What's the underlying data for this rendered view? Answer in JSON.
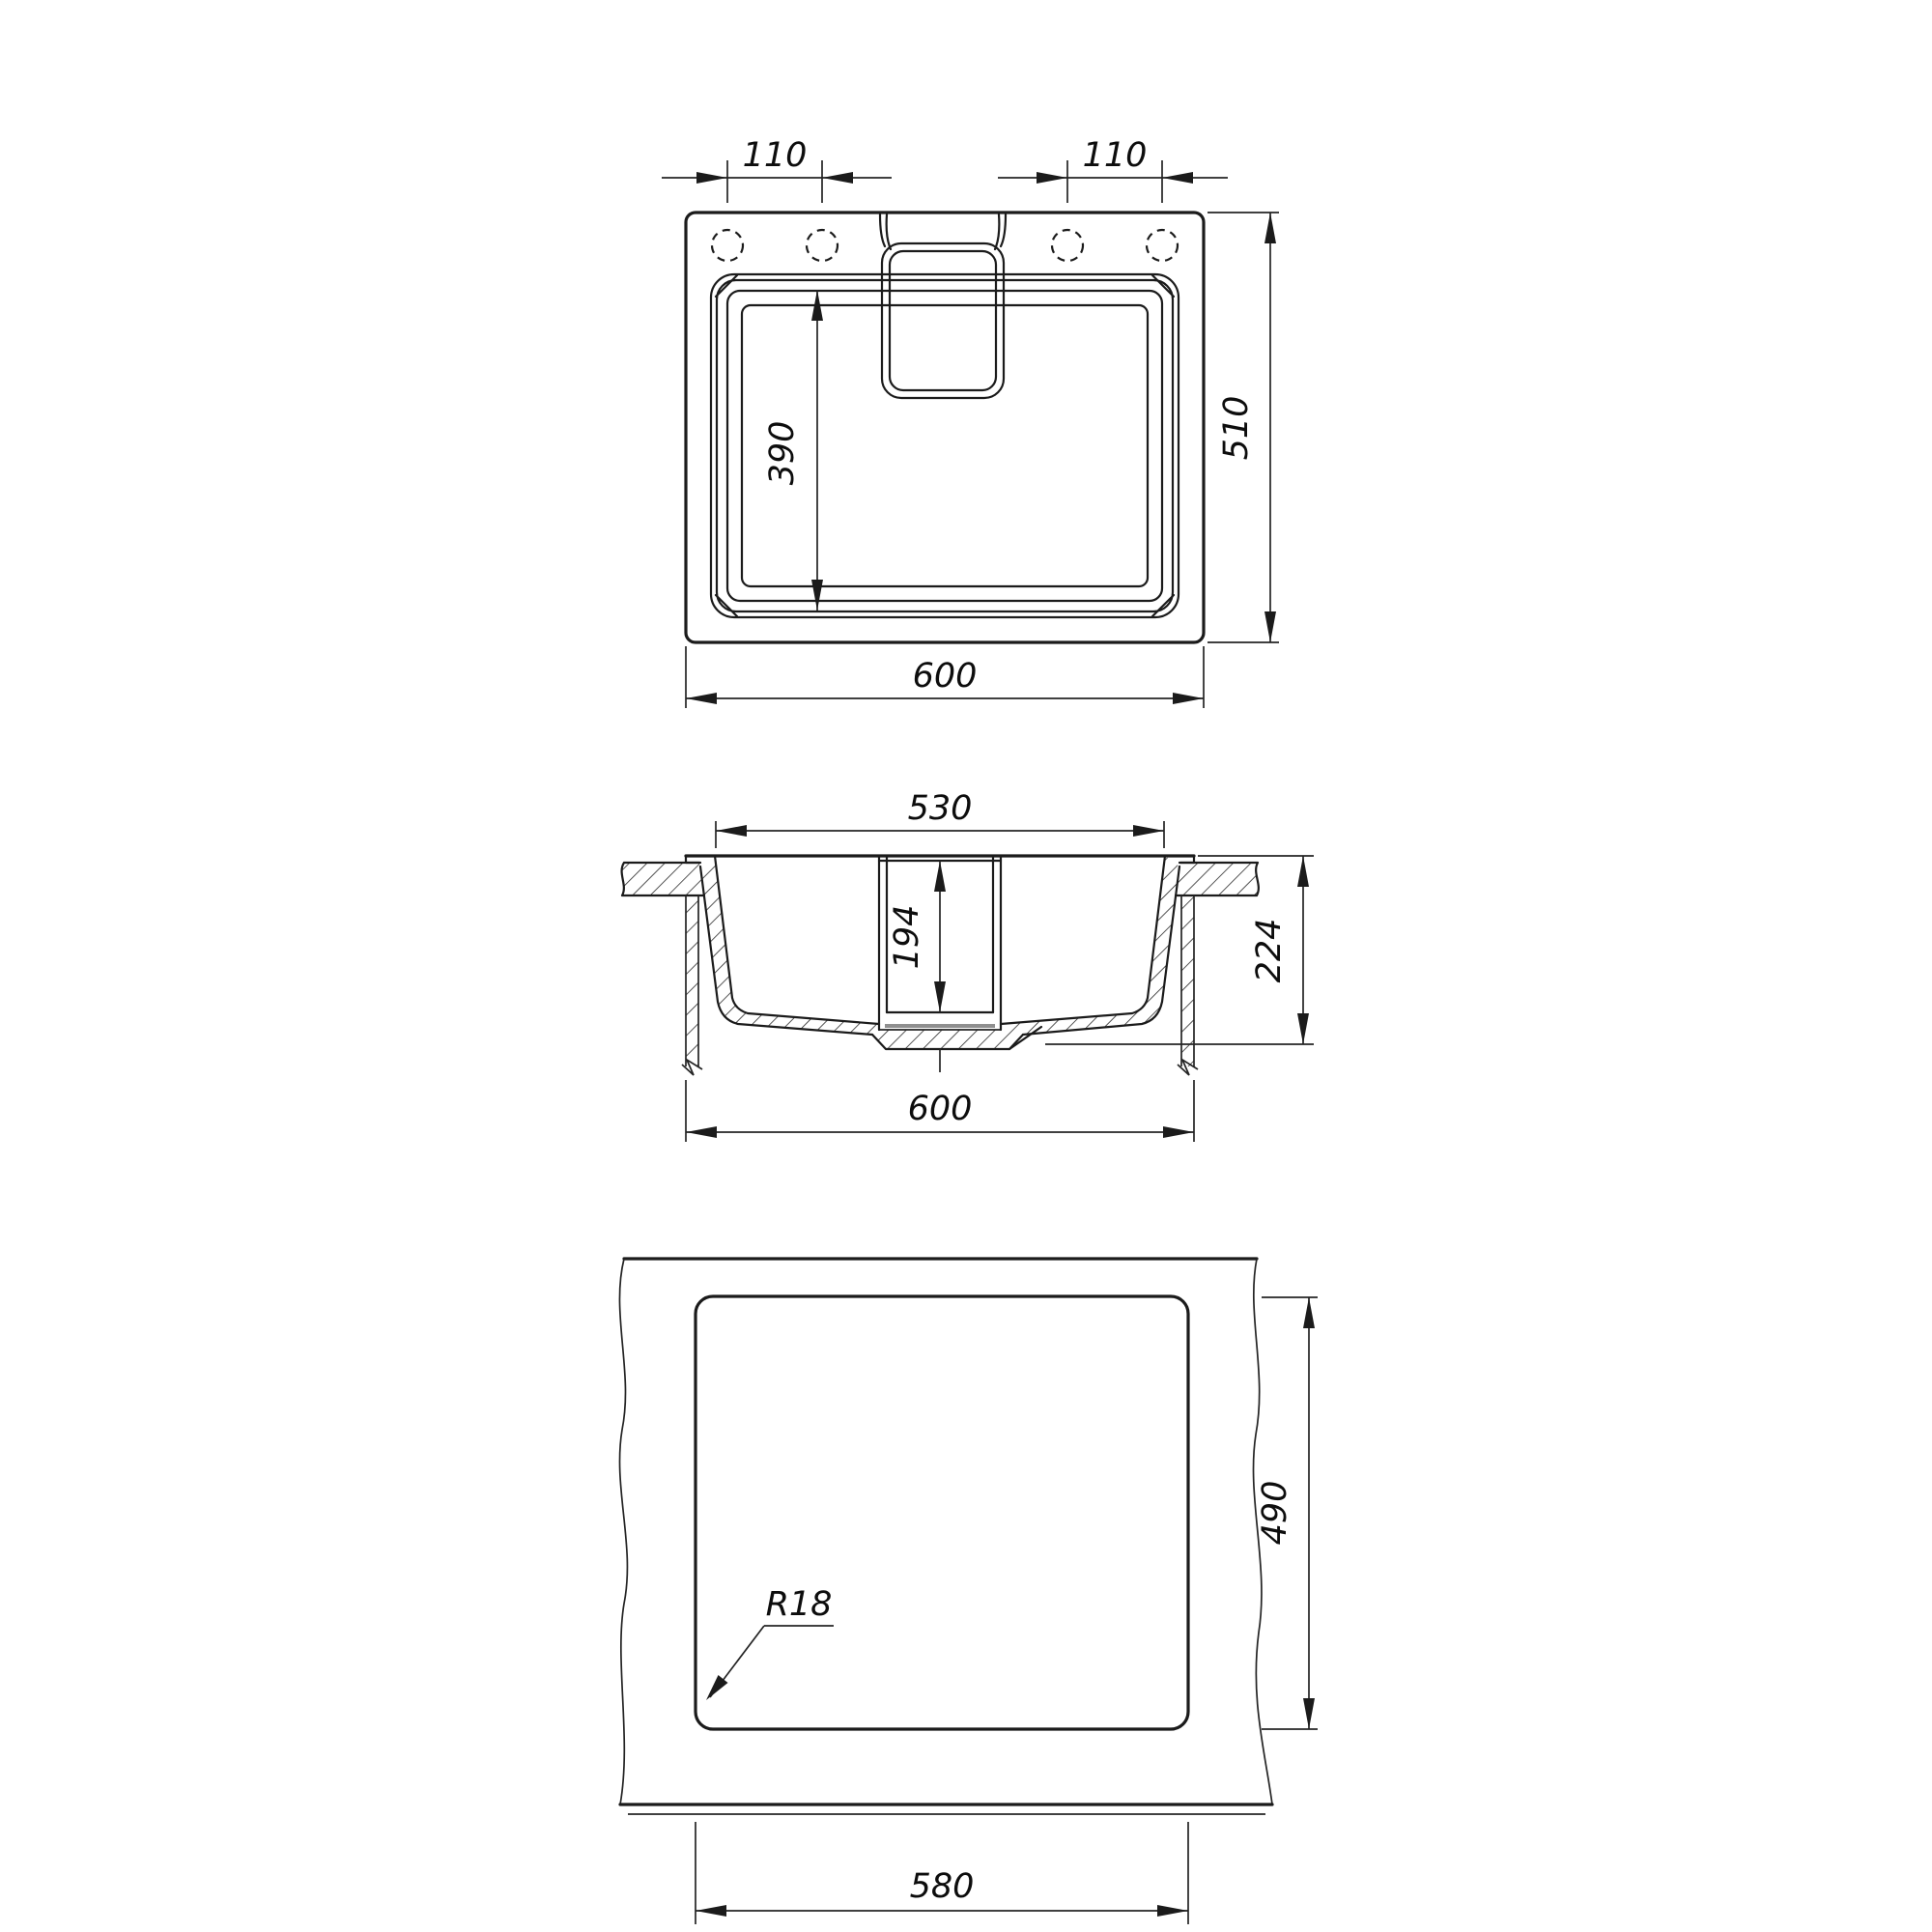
{
  "drawing": {
    "title": "Kitchen sink dimensional drawing",
    "views": {
      "top": {
        "name": "top view",
        "dims": {
          "hole_pitch_left": "110",
          "hole_pitch_right": "110",
          "overall_depth": "510",
          "bowl_length": "390",
          "overall_width": "600"
        }
      },
      "section": {
        "name": "front section view",
        "dims": {
          "bowl_opening_width": "530",
          "recess_depth": "194",
          "overall_height": "224",
          "overall_width": "600"
        }
      },
      "cutout": {
        "name": "installation cutout view",
        "dims": {
          "cutout_depth": "490",
          "corner_radius": "R18",
          "cutout_width": "580"
        }
      }
    }
  }
}
